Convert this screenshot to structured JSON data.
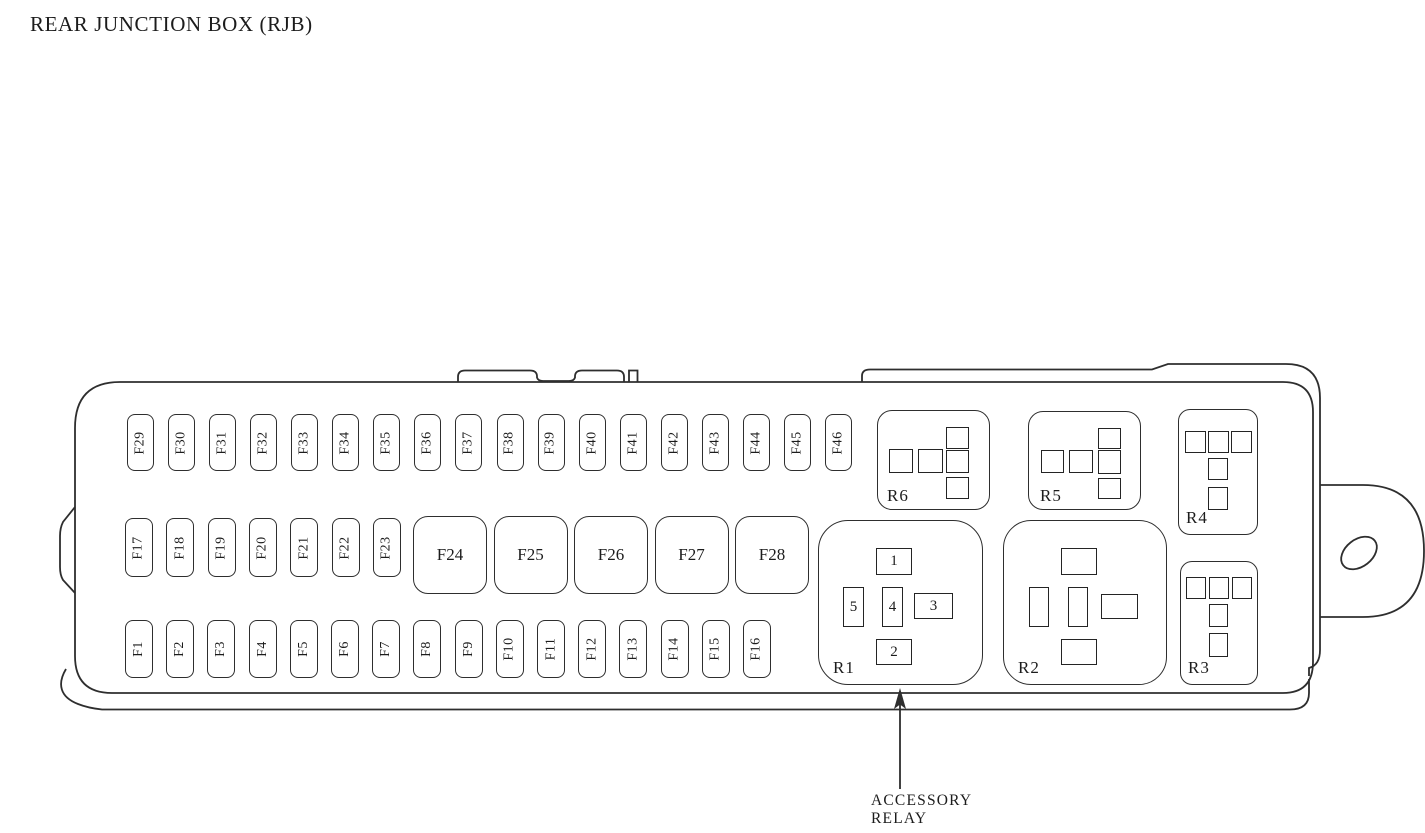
{
  "title": "REAR JUNCTION BOX (RJB)",
  "fuse_rows": {
    "top": [
      "F29",
      "F30",
      "F31",
      "F32",
      "F33",
      "F34",
      "F35",
      "F36",
      "F37",
      "F38",
      "F39",
      "F40",
      "F41",
      "F42",
      "F43",
      "F44",
      "F45",
      "F46"
    ],
    "middle_small": [
      "F17",
      "F18",
      "F19",
      "F20",
      "F21",
      "F22",
      "F23"
    ],
    "middle_large": [
      "F24",
      "F25",
      "F26",
      "F27",
      "F28"
    ],
    "bottom": [
      "F1",
      "F2",
      "F3",
      "F4",
      "F5",
      "F6",
      "F7",
      "F8",
      "F9",
      "F10",
      "F11",
      "F12",
      "F13",
      "F14",
      "F15",
      "F16"
    ]
  },
  "relays": [
    {
      "id": "R6",
      "label": "R6",
      "type": "micro-relay",
      "pin_labels": [
        "",
        "",
        "",
        "",
        ""
      ]
    },
    {
      "id": "R5",
      "label": "R5",
      "type": "micro-relay",
      "pin_labels": [
        "",
        "",
        "",
        "",
        ""
      ]
    },
    {
      "id": "R4",
      "label": "R4",
      "type": "t-pin-relay",
      "pin_labels": [
        "",
        "",
        "",
        "",
        ""
      ]
    },
    {
      "id": "R3",
      "label": "R3",
      "type": "t-pin-relay",
      "pin_labels": [
        "",
        "",
        "",
        "",
        ""
      ]
    },
    {
      "id": "R1",
      "label": "R1",
      "type": "five-pin-relay",
      "pin_labels": [
        "1",
        "5",
        "4",
        "3",
        "2"
      ]
    },
    {
      "id": "R2",
      "label": "R2",
      "type": "five-pin-relay",
      "pin_labels": [
        "",
        "",
        "",
        "",
        ""
      ]
    }
  ],
  "annotation": {
    "line1": "ACCESSORY",
    "line2": "RELAY"
  },
  "colors": {
    "line": "#2e2e2e",
    "text": "#1c1c1c",
    "background": "#ffffff"
  }
}
